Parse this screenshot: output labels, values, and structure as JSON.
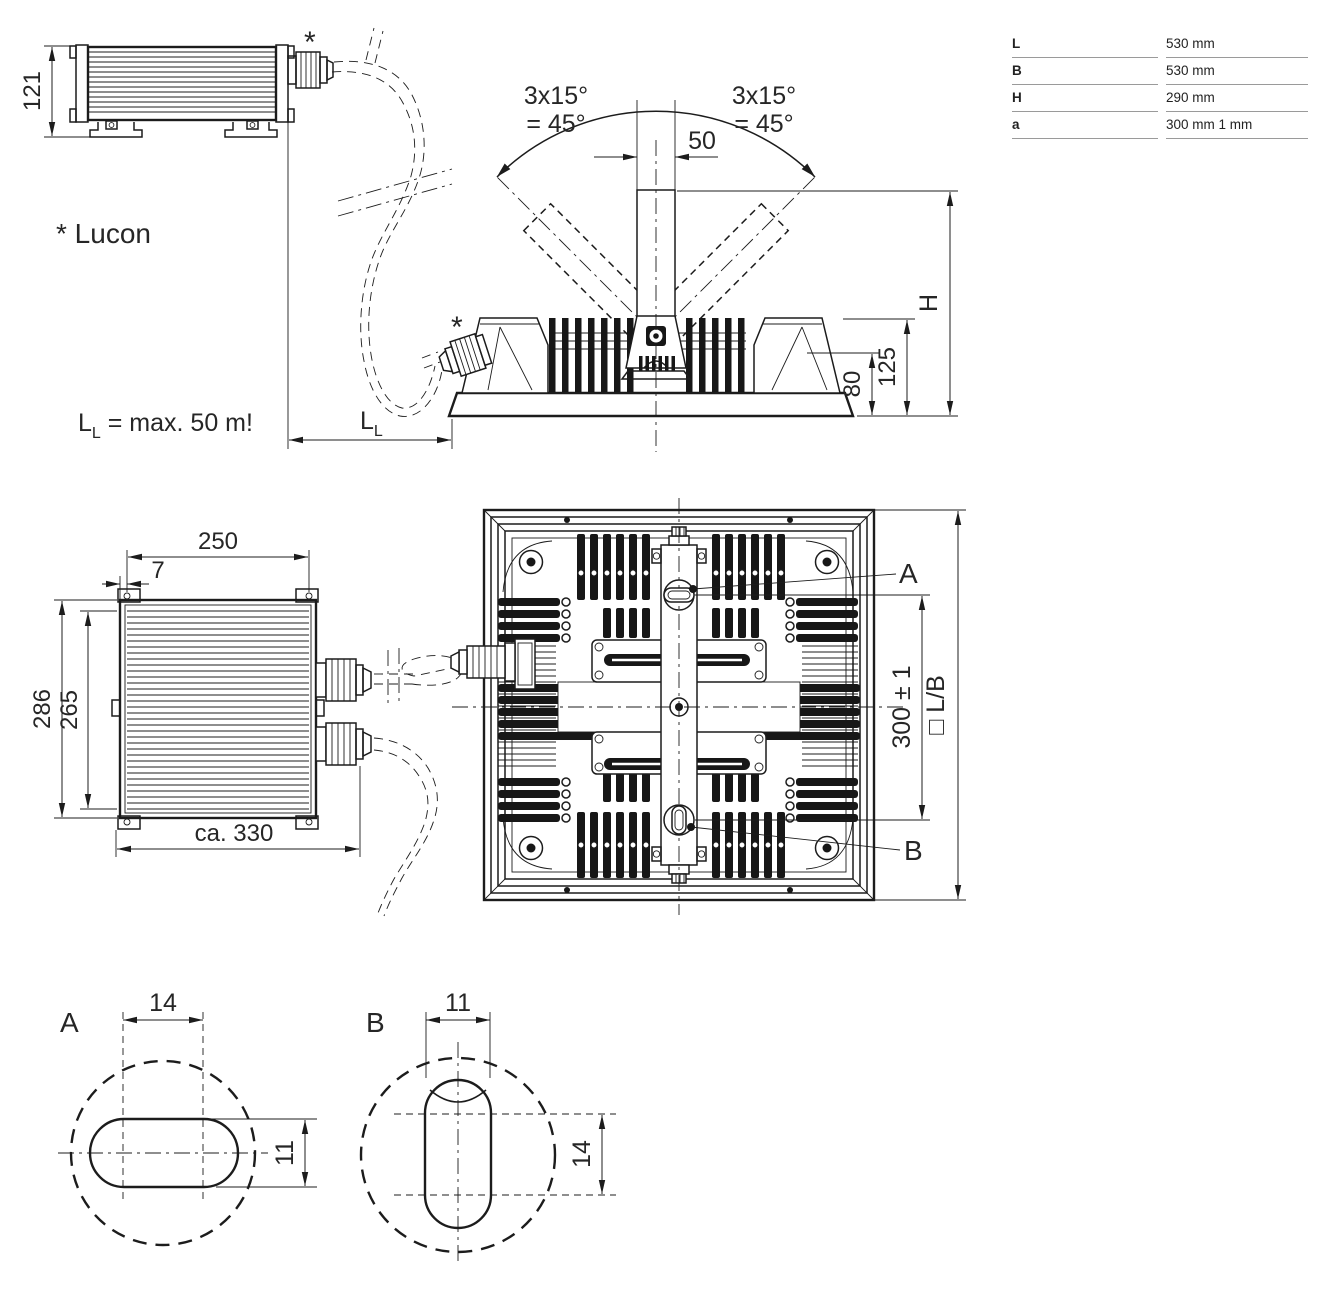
{
  "spec_table": {
    "rows": [
      {
        "key": "L",
        "value": "530 mm"
      },
      {
        "key": "B",
        "value": "530 mm"
      },
      {
        "key": "H",
        "value": "290 mm"
      },
      {
        "key": "a",
        "value": "300 mm 1 mm"
      }
    ]
  },
  "notes": {
    "lucon": "* Lucon",
    "cable_note_prefix": "L",
    "cable_note_sub": "L",
    "cable_note_suffix": " = max. 50 m!"
  },
  "driver_side": {
    "height": "121",
    "gland_mark": "*"
  },
  "luminaire_side": {
    "angle_left_line1": "3x15°",
    "angle_left_line2": "= 45°",
    "angle_right_line1": "3x15°",
    "angle_right_line2": "= 45°",
    "bracket_width": "50",
    "height_label": "H",
    "dim_80": "80",
    "dim_125": "125",
    "gland_mark": "*",
    "cable_dim_prefix": "L",
    "cable_dim_sub": "L"
  },
  "driver_top": {
    "width_250": "250",
    "offset_7": "7",
    "height_286": "286",
    "height_265": "265",
    "width_330": "ca. 330"
  },
  "luminaire_top": {
    "hole_a_label": "A",
    "hole_b_label": "B",
    "hole_spacing": "300 ± 1",
    "outline_label": "□ L/B"
  },
  "detail_a": {
    "label": "A",
    "slot_width": "14",
    "slot_height": "11"
  },
  "detail_b": {
    "label": "B",
    "slot_width": "11",
    "slot_height": "14"
  }
}
